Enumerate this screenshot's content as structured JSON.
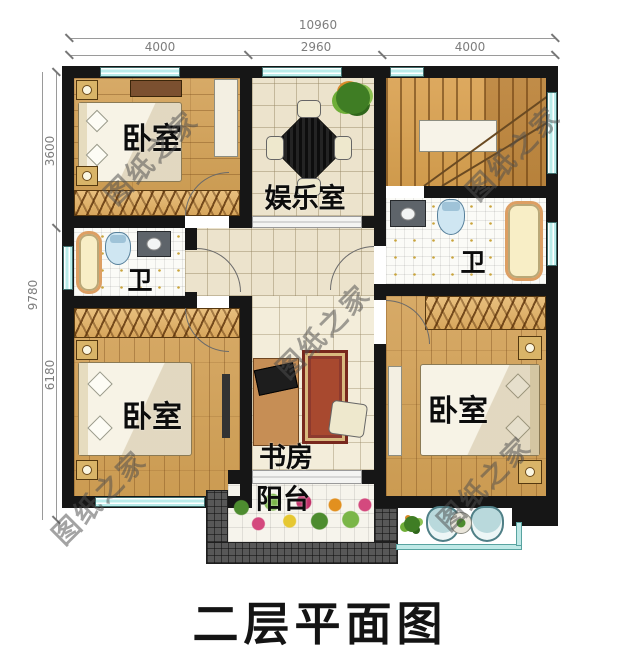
{
  "title": "二层平面图",
  "watermark": "图纸之家",
  "dimensions": {
    "top": {
      "total": "10960",
      "segments": [
        "4000",
        "2960",
        "4000"
      ]
    },
    "left": {
      "total": "9780",
      "segments": [
        "3600",
        "6180"
      ]
    }
  },
  "rooms": {
    "bedroom_top_left": "卧室",
    "entertainment": "娱乐室",
    "bathroom_left": "卫",
    "bathroom_right": "卫",
    "bedroom_bottom_left": "卧室",
    "bedroom_bottom_right": "卧室",
    "study": "书房",
    "balcony": "阳台"
  },
  "colors": {
    "wall": "#161616",
    "window": "#b9ecea",
    "wood_floor": "#d0a15f",
    "tile_floor": "#ece3cc",
    "wardrobe": "#e0b670",
    "parapet": "#585858",
    "dimension_text": "#7d7d7d",
    "watermark": "#4e4e4e"
  }
}
